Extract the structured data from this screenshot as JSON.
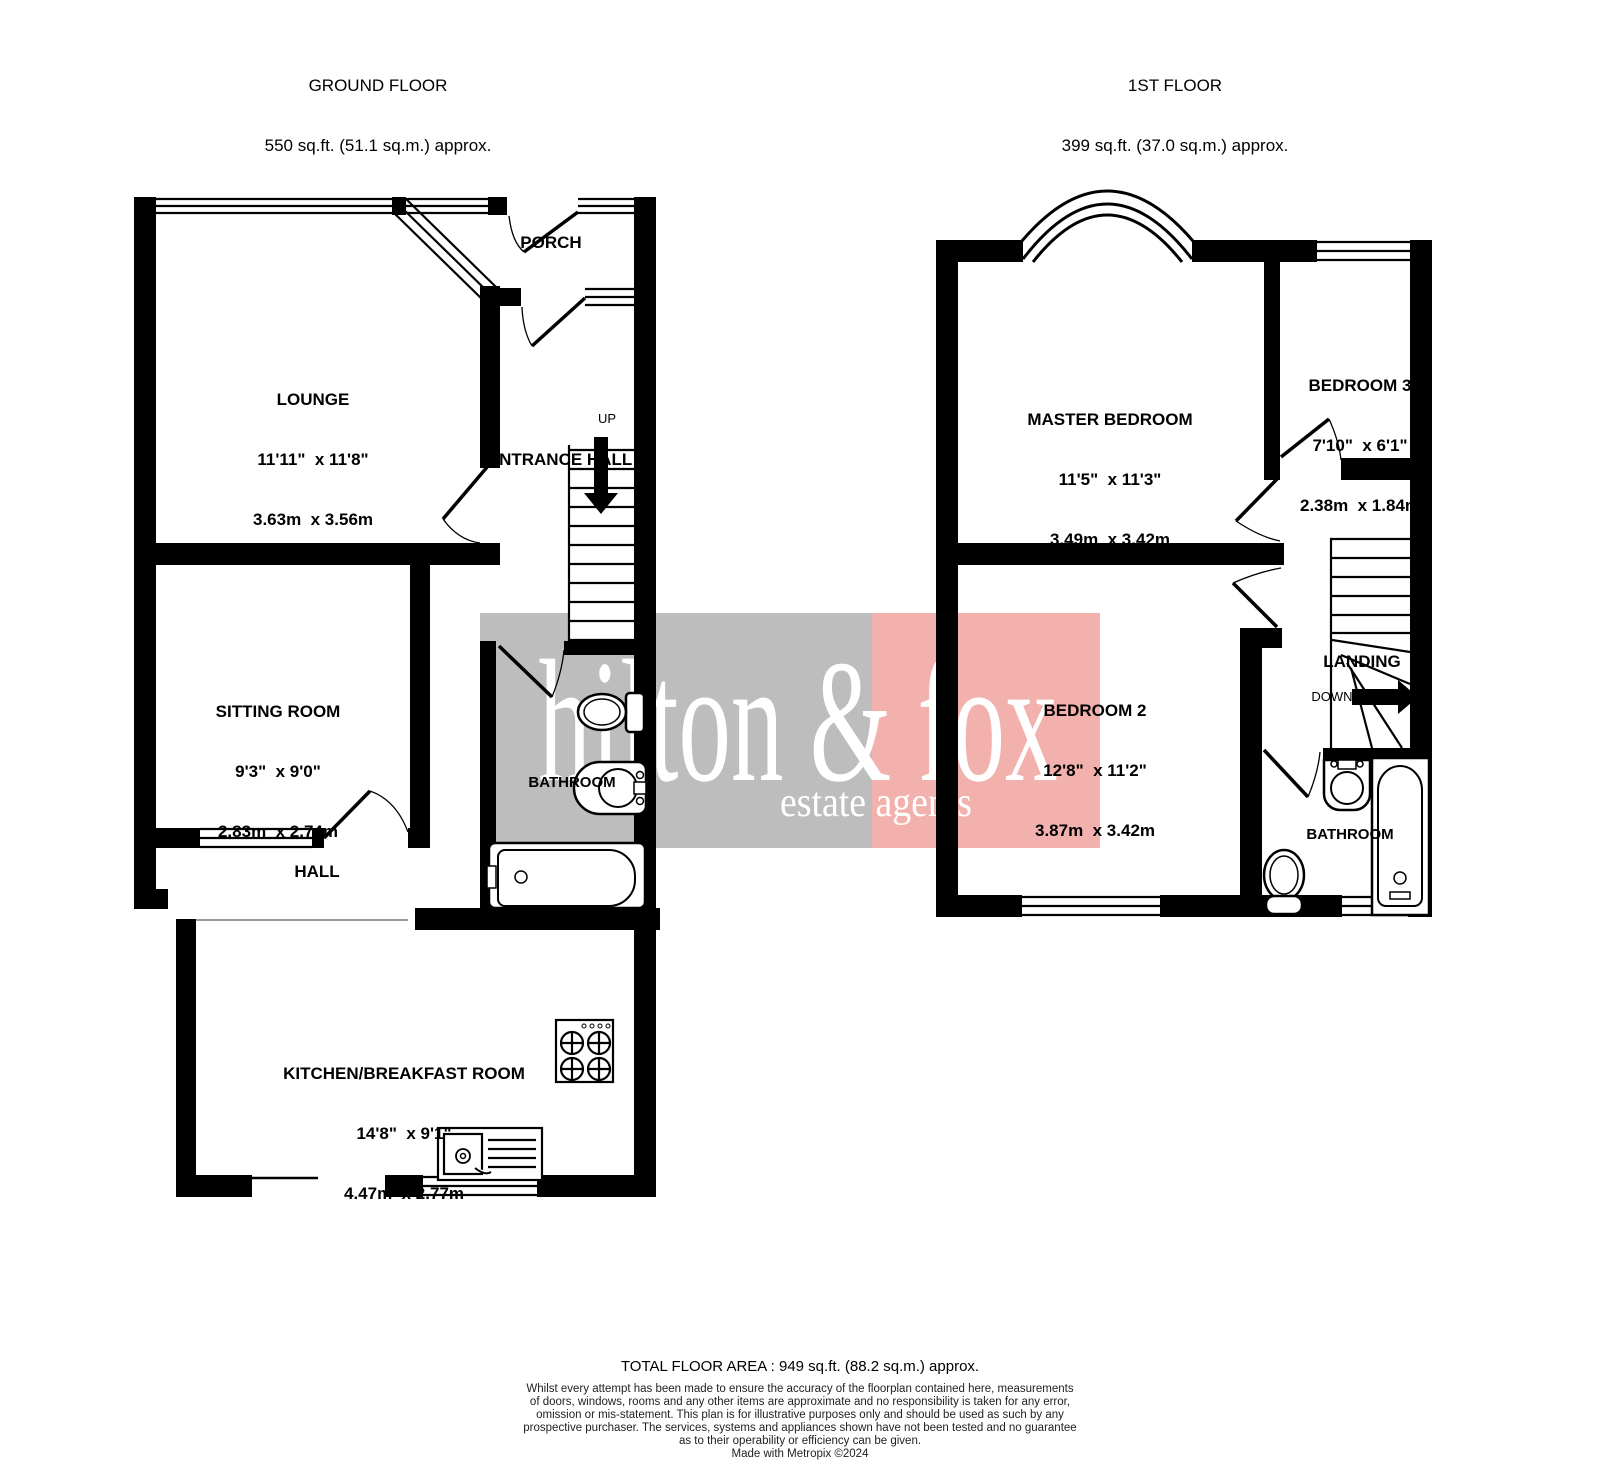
{
  "floors": [
    {
      "title": "GROUND FLOOR",
      "area": "550 sq.ft. (51.1 sq.m.) approx."
    },
    {
      "title": "1ST FLOOR",
      "area": "399 sq.ft. (37.0 sq.m.) approx."
    }
  ],
  "rooms": {
    "lounge": {
      "name": "LOUNGE",
      "dims_ft": "11'11\"  x 11'8\"",
      "dims_m": "3.63m  x 3.56m"
    },
    "porch": {
      "name": "PORCH"
    },
    "entrance_hall": {
      "name": "ENTRANCE HALL"
    },
    "sitting_room": {
      "name": "SITTING ROOM",
      "dims_ft": "9'3\"  x 9'0\"",
      "dims_m": "2.83m  x 2.74m"
    },
    "hall": {
      "name": "HALL"
    },
    "bathroom_gf": {
      "name": "BATHROOM"
    },
    "kitchen": {
      "name": "KITCHEN/BREAKFAST ROOM",
      "dims_ft": "14'8\"  x 9'1\"",
      "dims_m": "4.47m  x 2.77m"
    },
    "master_bedroom": {
      "name": "MASTER BEDROOM",
      "dims_ft": "11'5\"  x 11'3\"",
      "dims_m": "3.49m  x 3.42m"
    },
    "bedroom2": {
      "name": "BEDROOM 2",
      "dims_ft": "12'8\"  x 11'2\"",
      "dims_m": "3.87m  x 3.42m"
    },
    "bedroom3": {
      "name": "BEDROOM 3",
      "dims_ft": "7'10\"  x 6'1\"",
      "dims_m": "2.38m  x 1.84m"
    },
    "landing": {
      "name": "LANDING"
    },
    "bathroom_ff": {
      "name": "BATHROOM"
    }
  },
  "stairs": {
    "up_label": "UP",
    "down_label": "DOWN"
  },
  "watermark": {
    "line1": "hilton & fox",
    "line2": "estate agents",
    "gray_color": "#bdbdbd",
    "pink_color": "#f2b1ad",
    "text_color": "#ffffff"
  },
  "footer": {
    "total": "TOTAL FLOOR AREA : 949 sq.ft. (88.2 sq.m.) approx.",
    "disclaimer": [
      "Whilst every attempt has been made to ensure the accuracy of the floorplan contained here, measurements",
      "of doors, windows, rooms and any other items are approximate and no responsibility is taken for any error,",
      "omission or mis-statement. This plan is for illustrative purposes only and should be used as such by any",
      "prospective purchaser. The services, systems and appliances shown have not been tested and no guarantee",
      "as to their operability or efficiency can be given.",
      "Made with Metropix ©2024"
    ]
  }
}
